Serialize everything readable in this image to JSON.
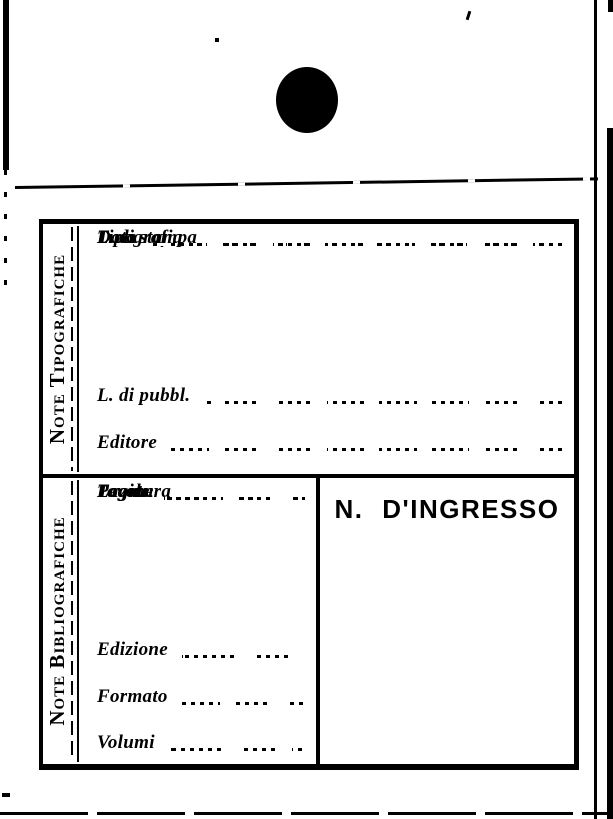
{
  "colors": {
    "ink": "#000000",
    "paper": "#ffffff"
  },
  "card": {
    "typographic_section": {
      "side_label": "Note Tipografiche",
      "fields": [
        {
          "label": "L. di pubbl.",
          "value": ""
        },
        {
          "label": "Editore",
          "value": ""
        },
        {
          "label": "L. di stampa",
          "value": ""
        },
        {
          "label": "Tipografia",
          "value": ""
        },
        {
          "label": "Data",
          "value": ""
        }
      ]
    },
    "bibliographic_section": {
      "side_label": "Note Bibliografiche",
      "fields": [
        {
          "label": "Edizione",
          "value": ""
        },
        {
          "label": "Formato",
          "value": ""
        },
        {
          "label": "Volumi",
          "value": ""
        },
        {
          "label": "Pagine",
          "value": ""
        },
        {
          "label": "Tavole",
          "value": ""
        },
        {
          "label": "Legatura",
          "value": ""
        }
      ],
      "ingresso_heading": "N. D'INGRESSO"
    },
    "marks": {
      "hole_punch": "filled-circle"
    }
  }
}
